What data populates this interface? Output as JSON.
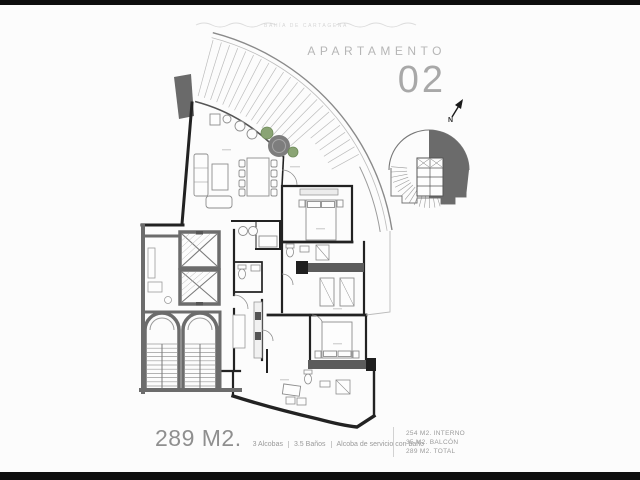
{
  "header": {
    "watermark": "BAHÍA DE CARTAGENA",
    "title_label": "APARTAMENTO",
    "title_number": "02"
  },
  "north": {
    "label": "N"
  },
  "summary": {
    "area_total": "289 M2.",
    "features": [
      "3 Alcobas",
      "3.5 Baños",
      "Alcoba de servicio con baño"
    ]
  },
  "stats": {
    "lines": [
      "254 M2. INTERNO",
      "35  M2. BALCÓN",
      "289 M2. TOTAL"
    ]
  },
  "colors": {
    "wall_black": "#222222",
    "core_gray": "#6c6c6c",
    "closet_band": "#5c5c5c",
    "highlight_gray": "#6b6b6b",
    "tree_green": "#8aa474",
    "title_gray": "#b6b6b6",
    "text_gray": "#9a9a9a"
  }
}
